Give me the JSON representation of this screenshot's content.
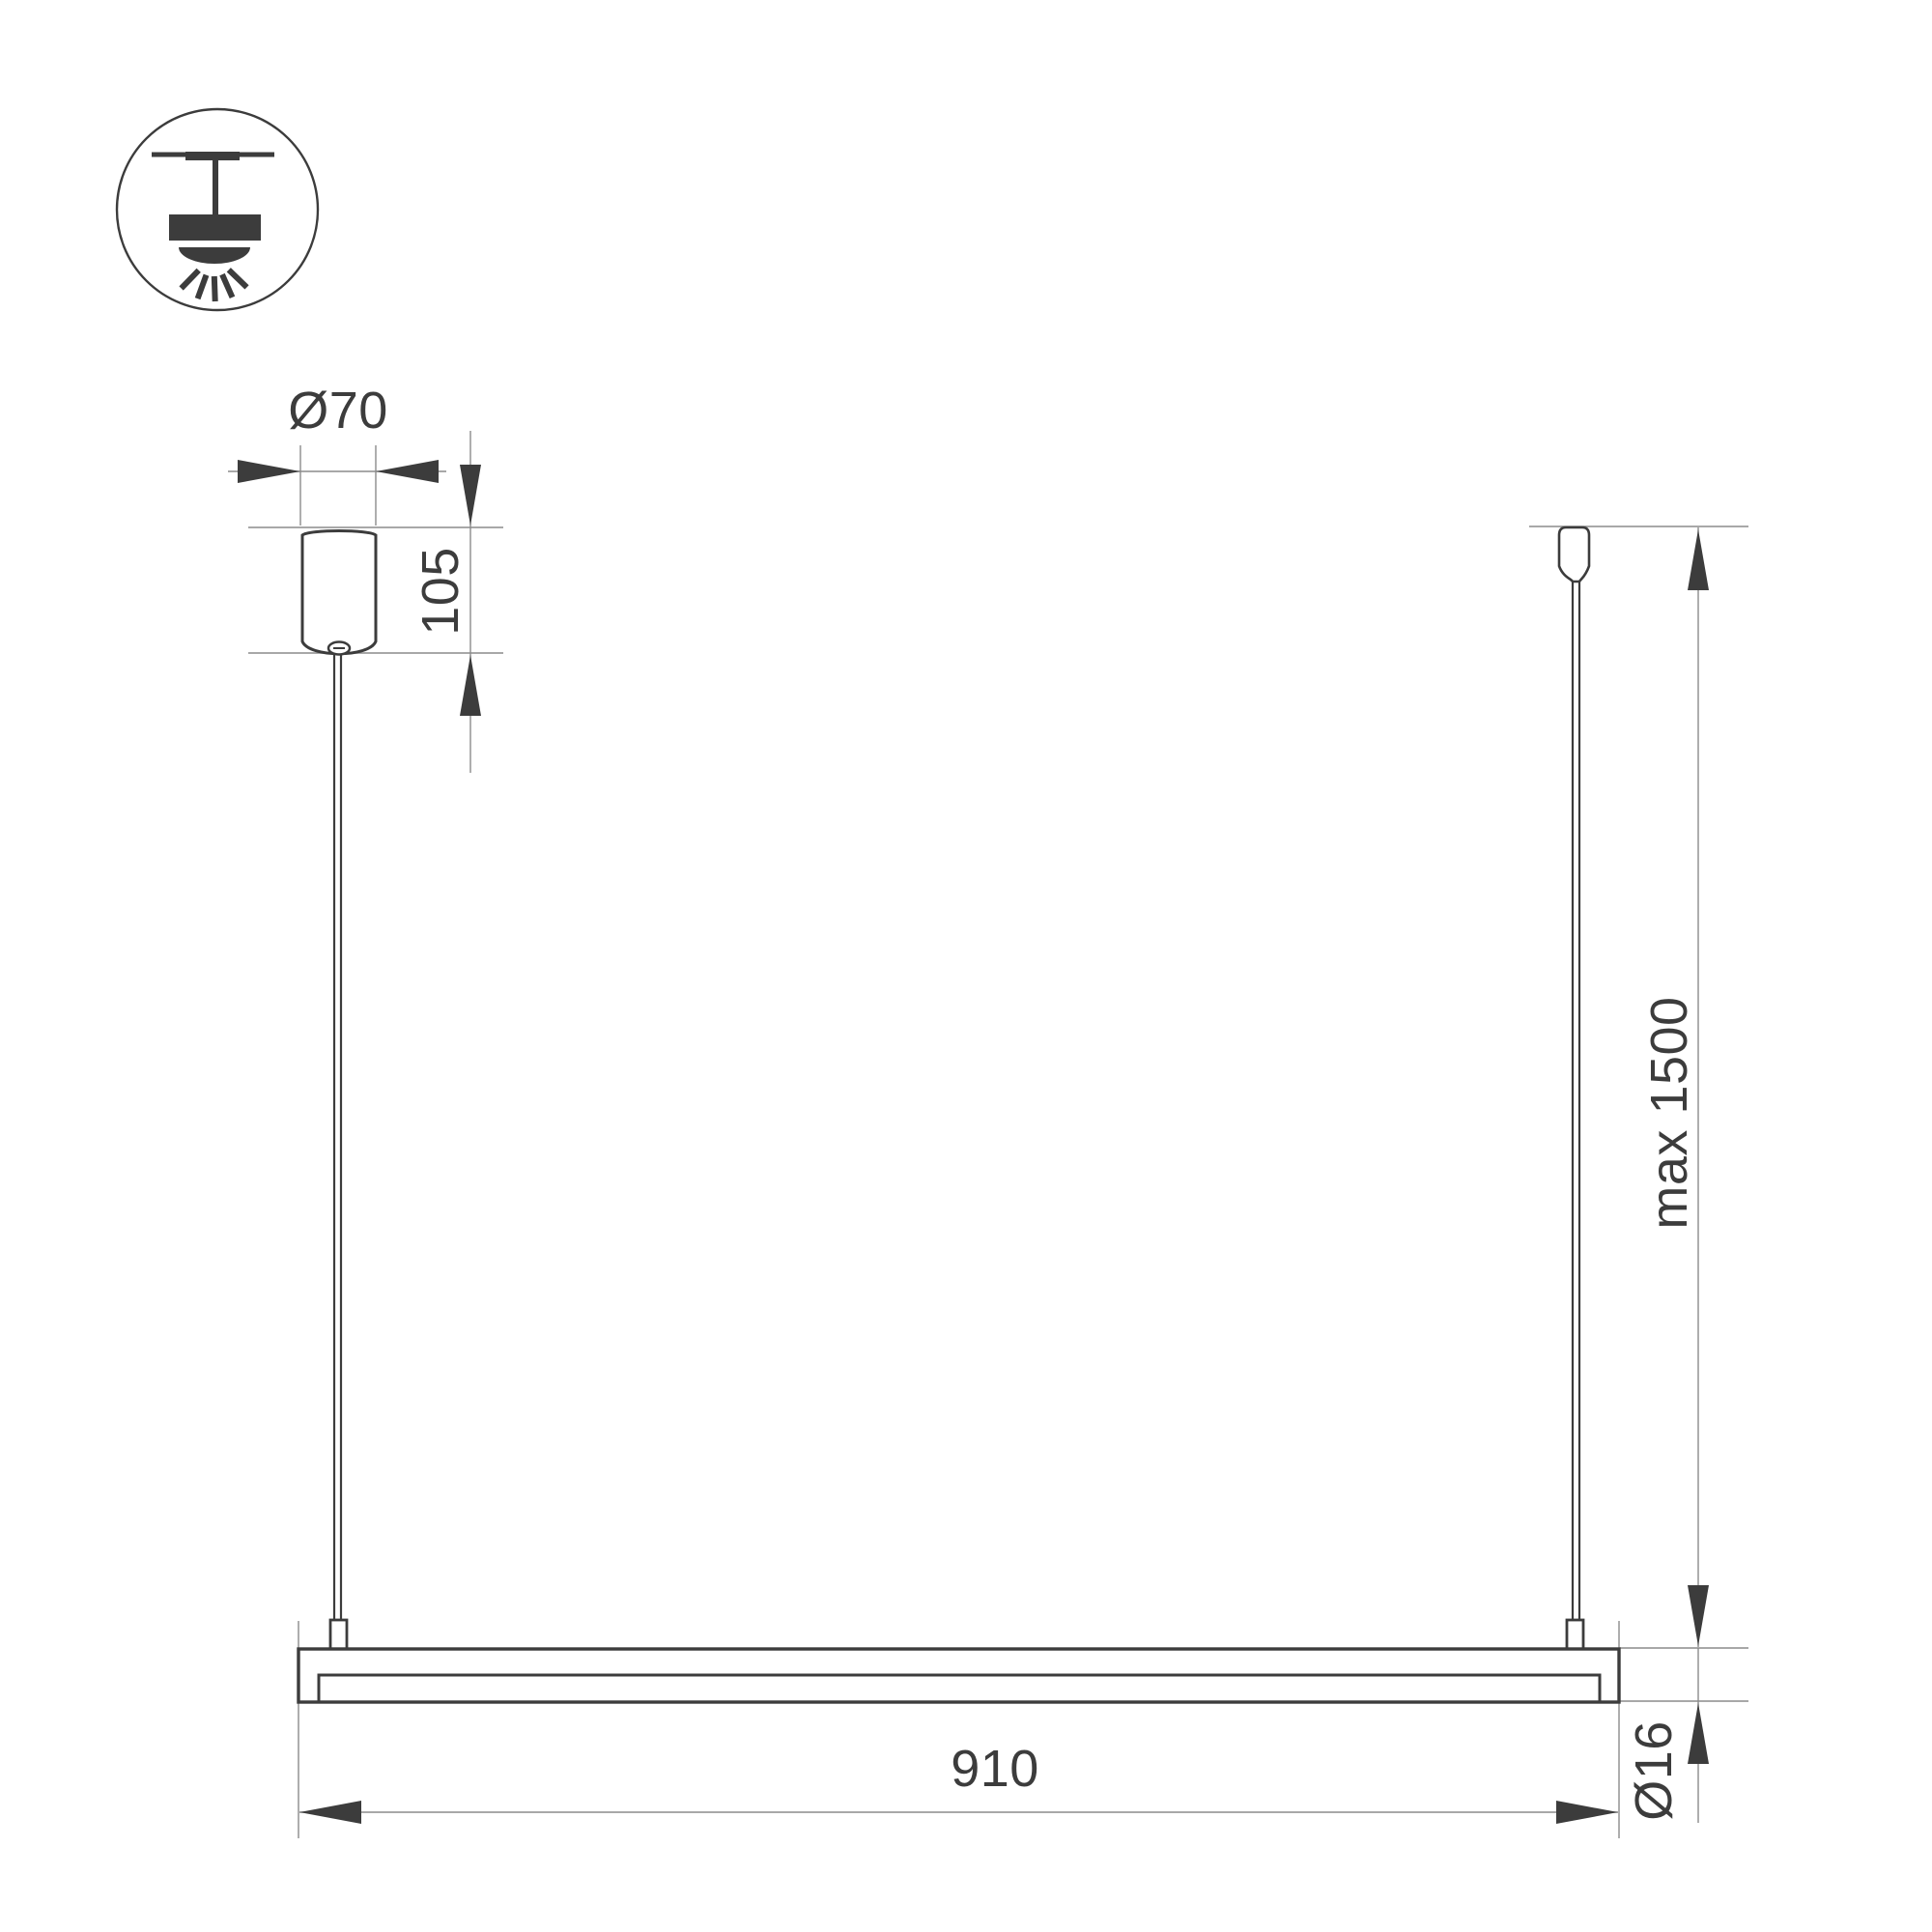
{
  "colors": {
    "ink": "#3c3c3c",
    "line": "#8c8c8c",
    "background": "#ffffff"
  },
  "drawing": {
    "icon": "ceiling-pendant-light",
    "labels": {
      "canopy_diameter": "Ø70",
      "canopy_height": "105",
      "max_suspension": "max 1500",
      "fixture_length": "910",
      "tube_diameter": "Ø16"
    }
  }
}
